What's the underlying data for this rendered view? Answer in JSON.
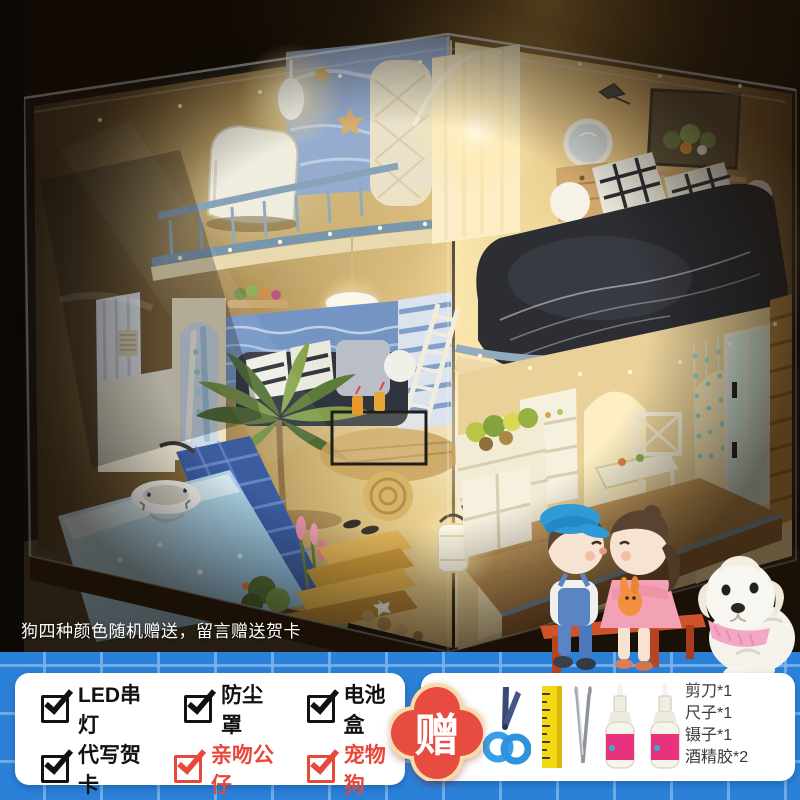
{
  "photo": {
    "caption": "狗四种颜色随机赠送，留言赠送贺卡",
    "subject": "DIY miniature dollhouse with LED lights in clear dust cover, couple and puppy figurines"
  },
  "promo_bar": {
    "background_color": "#2b80d8",
    "grid_color": "#7db4eb",
    "features": {
      "row1": [
        {
          "label": "LED串灯",
          "color": "#121212",
          "icon": "checkbox-checked-icon"
        },
        {
          "label": "防尘罩",
          "color": "#121212",
          "icon": "checkbox-checked-icon"
        },
        {
          "label": "电池盒",
          "color": "#121212",
          "icon": "checkbox-checked-icon"
        }
      ],
      "row2": [
        {
          "label": "代写贺卡",
          "color": "#121212",
          "icon": "checkbox-checked-icon"
        },
        {
          "label": "亲吻公仔",
          "color": "#e8473a",
          "icon": "checkbox-checked-icon"
        },
        {
          "label": "宠物狗",
          "color": "#e8473a",
          "icon": "checkbox-checked-icon"
        }
      ]
    },
    "gift_badge": {
      "label": "赠",
      "bg_color": "#e84c40",
      "border_color": "#f6dcab",
      "text_color": "#ffffff"
    },
    "gift_icons": [
      "scissors-icon",
      "ruler-icon",
      "tweezers-icon",
      "glue-bottle-icon",
      "glue-bottle-icon"
    ],
    "gift_items": [
      {
        "name": "剪刀*1"
      },
      {
        "name": "尺子*1"
      },
      {
        "name": "镊子*1"
      },
      {
        "name": "酒精胶*2"
      }
    ]
  }
}
